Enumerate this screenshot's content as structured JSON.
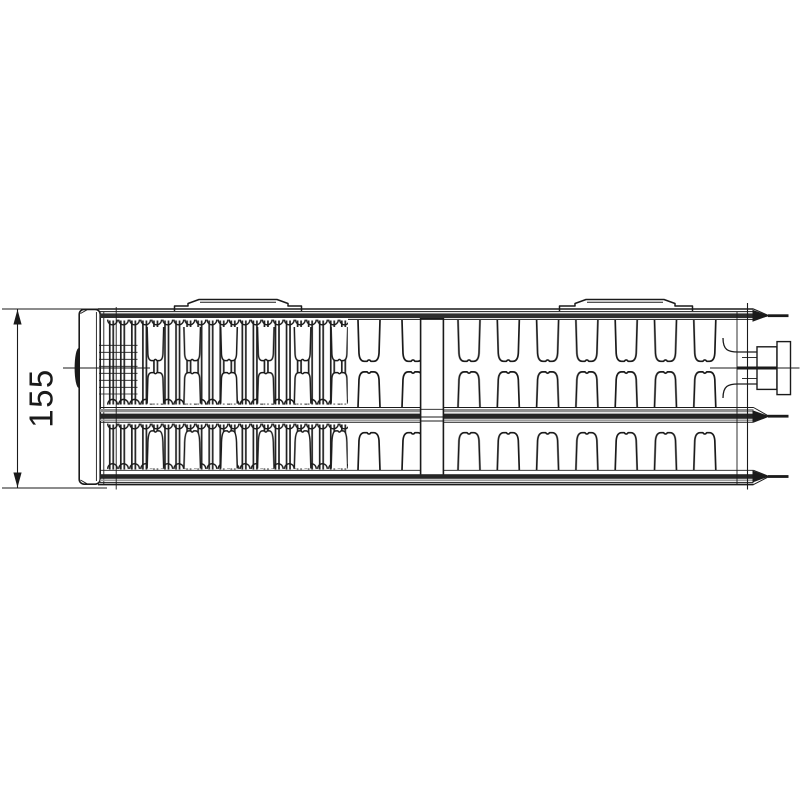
{
  "diagram": {
    "kind": "technical-drawing",
    "subject": "radiator-profile-top-view",
    "dimension": {
      "label": "155"
    },
    "colors": {
      "line": "#1a1a1a",
      "band_dark": "#262626",
      "band_gray": "#8f8f8f",
      "band_light_gray": "#9c9c9c",
      "background": "#ffffff"
    }
  }
}
